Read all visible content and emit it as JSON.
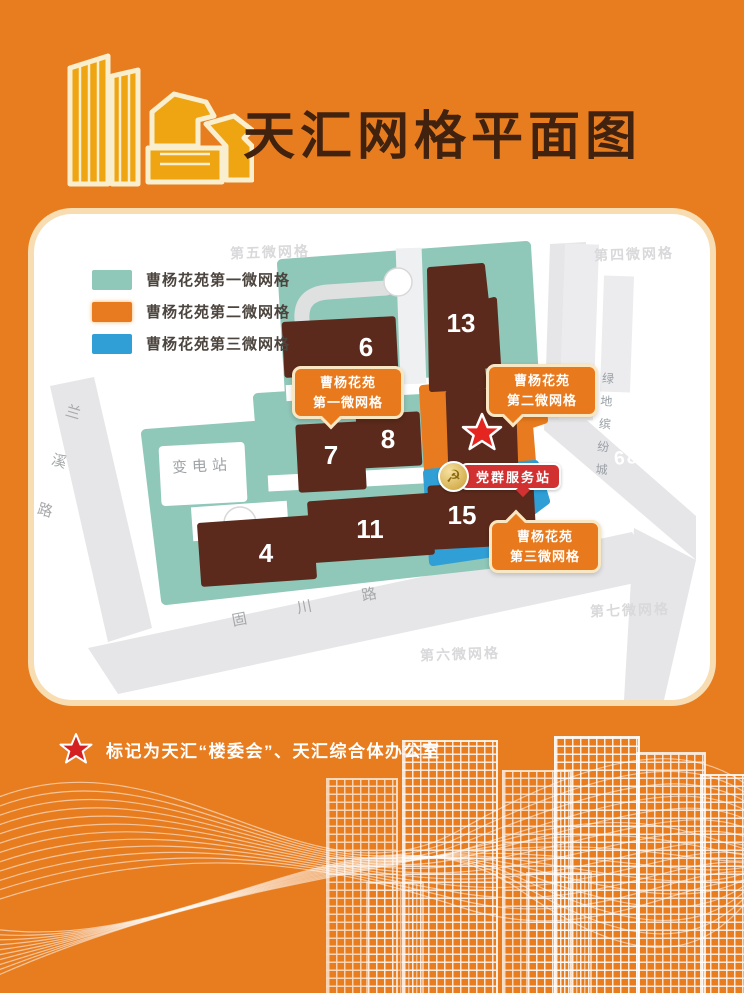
{
  "poster": {
    "title": "天汇网格平面图",
    "footnote": "标记为天汇“楼委会”、天汇综合体办公室"
  },
  "legend": {
    "items": [
      {
        "label": "曹杨花苑第一微网格",
        "color": "#8fc7b9"
      },
      {
        "label": "曹杨花苑第二微网格",
        "color": "#e87b1f"
      },
      {
        "label": "曹杨花苑第三微网格",
        "color": "#2f9fd6"
      }
    ]
  },
  "map": {
    "buildings": [
      {
        "num": "6"
      },
      {
        "num": "13"
      },
      {
        "num": "7"
      },
      {
        "num": "8"
      },
      {
        "num": "4"
      },
      {
        "num": "11"
      },
      {
        "num": "15"
      }
    ],
    "callouts": [
      {
        "line1": "曹杨花苑",
        "line2": "第一微网格"
      },
      {
        "line1": "曹杨花苑",
        "line2": "第二微网格"
      },
      {
        "line1": "曹杨花苑",
        "line2": "第三微网格"
      }
    ],
    "service_station": "党群服务站",
    "substation": "变电站",
    "roads": {
      "left": "兰溪路",
      "bottom": "固川路"
    },
    "mall": "绿地缤纷城",
    "road_numbers": "68 68",
    "adjacent_grids": {
      "g4": "第四微网格",
      "g5": "第五微网格",
      "g6": "第六微网格",
      "g7": "第七微网格"
    }
  },
  "icons": {
    "party_emblem": "☭"
  },
  "colors": {
    "background": "#e87d1f",
    "teal": "#8fc7b9",
    "orange": "#e87b1f",
    "blue": "#2f9fd6",
    "building": "#5b2a1c",
    "star_red": "#e52520",
    "label_red": "#d23131",
    "card": "#ffffff",
    "road_gray": "#e6e6e8"
  }
}
